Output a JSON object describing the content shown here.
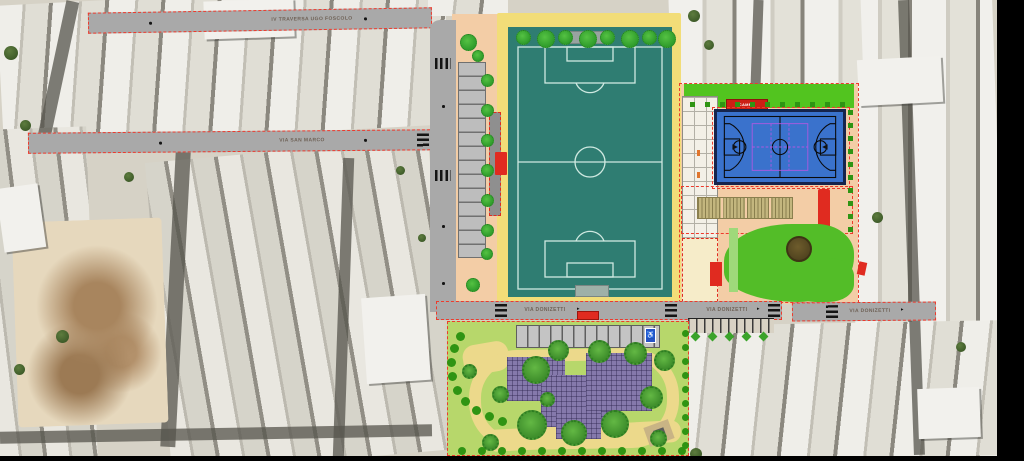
{
  "streets": {
    "iv_traversa_label": "IV TRAVERSA UGO FOSCOLO",
    "san_marco_label": "VIA SAN MARCO",
    "donizetti_label_1": "VIA DONIZETTI",
    "donizetti_label_2": "VIA DONIZETTI",
    "donizetti_label_3": "VIA DONIZETTI"
  },
  "facilities": {
    "multi_sport_court_label": "CAMPO POLIVALENTE"
  },
  "icons": {
    "disabled_parking_icon": "♿",
    "direction_arrow_icon": "▸"
  },
  "colors": {
    "plan_boundary_red": "#ee3a2c",
    "soccer_field_teal": "#2f7d72",
    "track_yellow": "#f2dd78",
    "basketball_blue": "#3a72cc",
    "volleyball_purple": "#ad58e0",
    "park_lime": "#b7d76b",
    "path_yellow": "#ecd98b",
    "plaza_salmon": "#f3cda6",
    "building_roof_purple": "#8579ab",
    "street_gray": "#a9a9a9"
  }
}
